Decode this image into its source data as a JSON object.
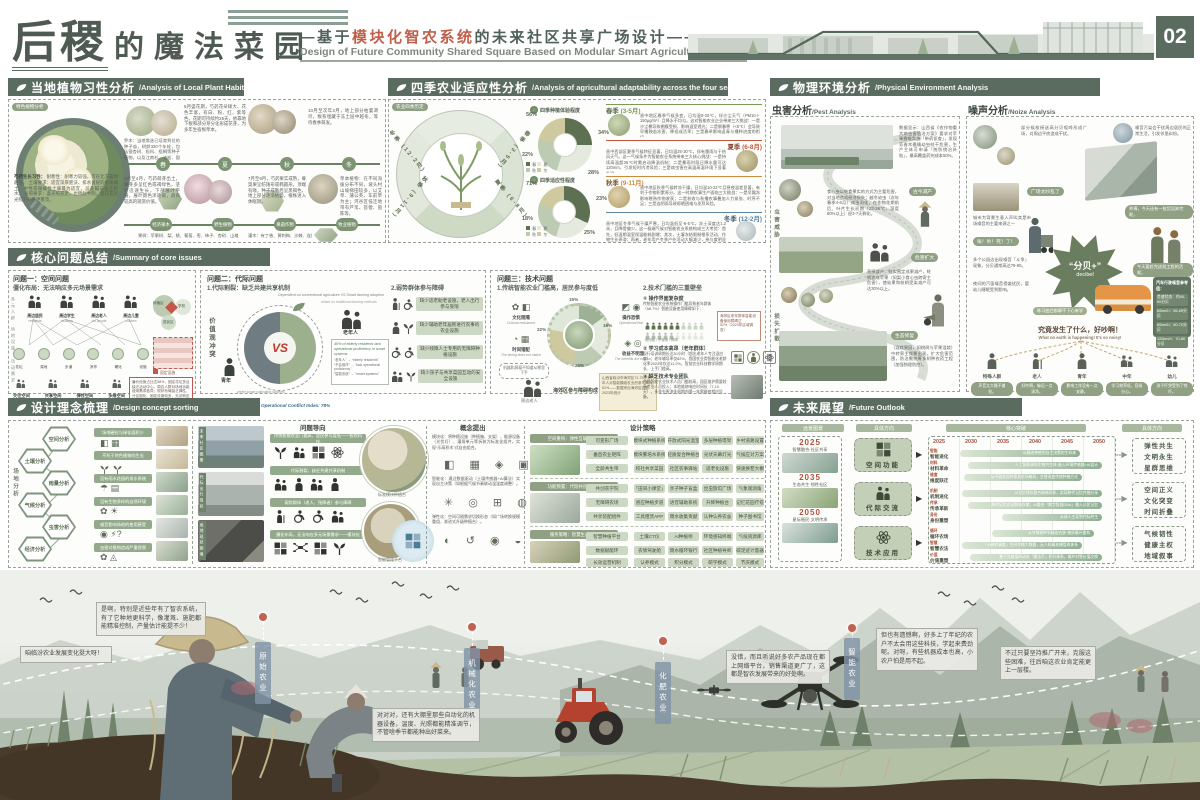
{
  "header": {
    "title_main": "后稷",
    "title_rest": "的魔法菜园",
    "subtitle_prefix": "——基于",
    "subtitle_highlight": "模块化智农系统",
    "subtitle_suffix": "的未来社区共享广场设计——",
    "subtitle_en": "Design of Future Community Shared Square Based on Modular Smart Agriculture System",
    "page_number": "02"
  },
  "plant": {
    "title": "当地植物习性分析",
    "title_en": "Analysis of Local Plant Habits",
    "tag": "特色植物分析",
    "seasons": [
      "春",
      "夏",
      "秋",
      "冬"
    ],
    "types": [
      "经济果木",
      "野生植物",
      "果蔬作物",
      "牧业植物"
    ],
    "note_may": "5月盛花期，芍药花朵硕大、花色丰富，有白、粉、红、紫等色，花期可持续约25天，依靠地下根和部分芽分化形成花芽，为多年生宿根草本。",
    "note_winter": "10月至次年2月，地上部分枯萎凋尽，根系埋藏于冻土层中越冬，等待春季萌发。",
    "note_spring": "3月至4月，芍药萌芽出土，嫩芽多呈红色或褐绿色，茎叶迅速生长，下部展叶平展，展叶期色泽艳丽，具有较高的观赏价值。",
    "note_autumn": "7月至9月，芍药果实成熟，蓇葖果呈纺锤形或椭圆形，顶端有喙，种子成熟后呈黑褐色，地上部分逐渐枯萎，植株进入休眠期。",
    "habit_title": "芍药生长习性：",
    "habit_1": "耐寒性：耐寒力较强，可在北方露地越冬。",
    "habit_2": "土壤要求：适宜深厚肥沃、排水良好的砂质壤土，中性或微碱性土壤最为适宜，忌盐碱与低洼积水。",
    "habit_3": "光照要求：喜光照充足，也稍耐半阴，但在充足光照下开花更繁茂。",
    "note_tree": "乔木：当地常选已培育到位的种子苗，树龄330个年轮，包括银杏树、松科、梧桐等种子植物，以及江南杉、油松、国槐、皂荚子等乔木。",
    "note_fruit": "果树：苹果树、梨、桃、葡萄、枣、柿子、杏树、山楂、猕猴桃；其中，苹果因其丰产稳产、果实好大，包括早熟、晚熟、酿造类。",
    "note_herb": "草本植物：在不同海拔分布不同，坡头村山坡梯田较多，以艾草、蒲公英、车前草为主；河谷区低洼地带有芦苇、苜蓿、茵陈等。",
    "note_shrub": "灌木：有丁香、黄刺梅、沙棘、连翘、文冠果、忍冬、榆叶梅、野蔷薇、胡枝子、山荆子等。"
  },
  "seasons": {
    "title": "四季农业适应性分析",
    "title_en": "Analysis of agricultural adaptability across the four seasons",
    "tag": "农业四季历定",
    "wheel": [
      "春季 (3-5月)",
      "夏季 (6-8月)",
      "秋季 (9-11月)",
      "冬季 (12-2月)"
    ],
    "donut1_title": "四季种植体验程度",
    "donut2_title": "四季适应性程度",
    "legend": [
      "春",
      "夏",
      "秋",
      "冬"
    ],
    "donut1": [
      "56%",
      "34%",
      "28%",
      "22%"
    ],
    "donut2": [
      "71%",
      "23%",
      "25%",
      "18%"
    ],
    "blocks": [
      {
        "name": "春季",
        "months": "(3-5月)",
        "text": "晋中地区春季气候多变，日均温8-20℃，伴沙尘天气（PM10＋150μg/m³）且降水不均匀。这对智能农业企业带来三大挑战：一是沙尘暴导致棚膜受损、影响温室透光；二是倒春寒（<5℃）会导致早播秧苗冻害、降低成活率；三是春旱影响返青与播种进度的衔接。"
      },
      {
        "name": "夏季",
        "months": "(6-8月)",
        "text": "晋中西部区夏季气候特征显著，日均温25-30℃，伴有雷雨与干热风天气。这一气候条件为智能农业系统带来三大核心挑战：一是持续高温超35℃时需启动降温机制；二是暴雨时段日降水量可达120mm，引发短时内涝风险；三是病虫害在高温高湿环境下显著升温。"
      },
      {
        "name": "秋季",
        "months": "(9-11月)",
        "text": "晋中地区秋季气候转凉干燥，日均温10-22℃且昼夜温差显著，有利于作物积累养分。这一时期农事生产面临三大挑战：一是早霜冻影响晚熟作物收获；二是秋收与秋播农事叠加人力紧张、时序不足；三是连阴雨导致晾晒困难与发芽风险。"
      },
      {
        "name": "冬季",
        "months": "(12-2月)",
        "text": "晋中地区冬季气候干燥严寒，日均温低至-8-5℃，冻土深度达1.2米，且降雪偏少。这一极端气候对智能农业系统构成三大考验：首先，低温期温室保温能耗剧增；其次，土壤冻结限制根系活动、作物生长停滞；再者，老年用户冬季户外活动大幅减少，参与度明显下降。"
      }
    ]
  },
  "physical": {
    "title": "物理环境分析",
    "title_en": "Physical Environment Analysis",
    "pest": {
      "title": "虫害分析",
      "title_en": "Pest Analysis",
      "side1": "虫害威胁",
      "side2": "损失扩散",
      "t1": "数据显示：山西省《农作物重大病虫害防治方案》要求对苹果蠹蛾实施「带药侦查」，发现芳香木蠹蛾幼虫蛀干危害，生产主体可申请「统防统治补贴」，最高覆盖药剂成本50%。",
      "t2": "食心虫以蛀食果实的方式为主要危害，对当地造成经济损失；越冬幼虫（次年春季4-6月）成虫羽化，在作物花期前后、叶片生长初期（23-28℃，湿度80%以上）经3-7天孵化。",
      "t3": "直接减产：蛀实围定成果减产，蛀梢造成苹果（如梨小食心虫跨寄主危害），使幼果和枝梢受染减产可达30%以上。",
      "t4": "（混栽果园，如桃树与苹果混栽）中转寄主频繁出现，扩大危害范围，防治需统筹多树种农药工程（加强物理防控）。",
      "pill1": "古今减产",
      "pill2": "危害扩大",
      "pill3": "生态修复"
    },
    "noise": {
      "title": "噪声分析",
      "title_en": "Noize Analysis",
      "star": "“分贝+”",
      "star_en": "decibel",
      "t1": "部分候校接送高分贝喧哗形成广场，对周边平房造成干扰。",
      "t2": "噪音污染会干扰周边居民的正常生活，引发邻里纠纷。",
      "t3": "城市为背景生意人声叫卖是市场噪音的主要来源之一",
      "t4": "多个公园边出现噪音「斗争」现象，分贝通常高达79-90。",
      "t5": "夜间的汽笛噪音侵袭扰民，婴幼儿睡眠受到影响。",
      "b1": "广场太吵乱了",
      "b2": "师傅，今天还有一批货没卸完呢。",
      "b3": "唉！吵！死！了！",
      "b4": "今天要赶完这批工程的活呢。",
      "b5": "练习曲目都静不下心来学",
      "car_title": "汽车行驶噪音参考值：",
      "car_lines": [
        "怠速状态：约40-50分贝",
        "60km/h：55-65分贝",
        "80km/h：60-70分贝",
        "120km/h：70-80分贝"
      ],
      "center": "究竟发生了什么，好吵啊！",
      "center_en": "What on earth is happening! It's so noisy!",
      "groups": [
        {
          "name": "特殊人群",
          "note": "声音太大睡不着觉。"
        },
        {
          "name": "老人",
          "note": "好吵啊，躲远一点清净。"
        },
        {
          "name": "青年",
          "note": "影响工作没有一点安静。"
        },
        {
          "name": "中年",
          "note": "学习效率低，容易分心。"
        },
        {
          "name": "幼儿",
          "note": "孩子吓哭受到了惊吓。"
        }
      ]
    }
  },
  "issues": {
    "title": "核心问题总结",
    "title_en": "Summary of core issues",
    "p1": {
      "title": "问题一：空间问题",
      "sub": "僵化布局：无法响应多元场景需求",
      "crowd": [
        "周边居民",
        "周边学生",
        "周边老人",
        "周边儿童"
      ],
      "crowd_en": [
        "residents",
        "students",
        "old people",
        "children"
      ],
      "sides": [
        "多元人群",
        "场地设施",
        "活动需求"
      ],
      "nodes": [
        "花坛",
        "菜地",
        "步道",
        "凉亭",
        "硬化",
        "设施"
      ],
      "zones": [
        "种植区",
        "学校",
        "居民区"
      ],
      "legend": "固定设施",
      "red_note": "廉价设施占比达58%，固定花坛多且缺乏活动中心，周边人群对场地功能使用需求各异；现状布局缺乏弹性、分区固化、固定设施较多，无法响应人群对功能切换与多样活动的需求。",
      "spaces": [
        "交往空间",
        "共享空间",
        "弹性空间",
        "多维空间"
      ]
    },
    "p2": {
      "title": "问题二：代际问题",
      "sub1": "1.代际割裂：缺乏共建共享机制",
      "sub2": "2.弱势群体参与障碍",
      "vs_top": "Dependent on conventional agriculture VS Smart farming adoption",
      "vs_sub": "reliant on traditional farming methods",
      "left_label": "价值观冲突",
      "youth": "青年",
      "elder": "老年人",
      "vs": "VS",
      "youth_note": "prefer smart cultivation systems",
      "stat": "40% of elderly residents lack operational proficiency in smart systems",
      "gloss1": "“老年人” → “elderly residents”",
      "gloss2": "“不会操作” → “lack operational proficiency”",
      "gloss3": "“智能系统” → “smart systems”",
      "conflict": "Operational Conflict Index: 78%",
      "barriers": [
        "缺少适老助老设施，老人出行参与受限",
        "缺少辅助老年居民进行农事的农业设施",
        "缺少残障人士专用的无障碍种植设施",
        "缺少孩子与共享菜园互动的安全设施"
      ]
    },
    "p3": {
      "title": "问题三：技术问题",
      "sub1": "1.传统智能农业门槛高，居民参与度低",
      "ring": [
        {
          "label": "文化阻隔",
          "en": "Cultural resistance",
          "v": "15%"
        },
        {
          "label": "时间错配",
          "en": "The timing does not match",
          "v": "22%"
        },
        {
          "label": "操作恐惧",
          "en": "Operational fear",
          "v": "16%"
        },
        {
          "label": "收益不明显",
          "en": "The benefits are unclear",
          "v": "25%"
        }
      ],
      "bubble": "机器和屏幕不知道从哪里下手",
      "person": "周边老人",
      "center_note": "海郊区参与障碍构成",
      "foot": "山西省临汾市海郊区71-75岁老年人对智能模组农业的参与率为51%——数据来自海郊区农委2023年统计",
      "sub2": "2.技术门槛的三重壁垒",
      "w1_t": "① 操作界面复杂度",
      "w1_d": "传统智能农业系统操作门槛导致老年群体（58.7%）智能设备使用障碍如下：",
      "w1_side": "海郊区老年群体智能设备使用障碍达52%（2023年区域调查）",
      "w1_leg": "使用者 / 不使用 / 障碍",
      "w2_t": "② 学习成本高昂（老年群体）",
      "w2_d": "现行培训周期长达30小时（超出老年人专注适应度）；老年辅导率仅82%，我国农业类智能化老龄化率2023年仅达11.2%，智慧农业科技教学周期长、上手门槛高。",
      "w3_t": "③ 缺乏技术专业团队",
      "w3_d": "传统智能农业技术人员门槛较高，园区维护需要较多专业人员投入；本地维修响应时间长（7-10天），多季虫害流失周期内隔一年需维修相应设备。"
    }
  },
  "design": {
    "title": "设计理念梳理",
    "title_en": "Design concept sorting",
    "side": "场地分析",
    "hex": [
      "空间分析",
      "土壤分析",
      "雨量分析",
      "气候分析",
      "虫害分析",
      "经济分析"
    ],
    "issues": [
      "场地硬化与绿化面积少",
      "不利于特色植物的生长",
      "没有雨水花园的排水系统",
      "没有生物多样的自然环境",
      "噪音影响场地的使用感受",
      "虫害对植物造成严重侵害"
    ],
    "photo_tags": [
      "未来社区图景",
      "代际出行现状",
      "场地现状困境"
    ],
    "problem_title": "问题导向",
    "problems": [
      "传统智能农业门槛高，居民参与度低——智农科技",
      "代际割裂，缺乏共建共享机制",
      "弱势群体（老人、残障者）参与障碍",
      "僵化布局，无法响应多元场景需求——模块化"
    ],
    "circle1": "标准模块种植台",
    "circle2": "智能管理平台",
    "concept_title": "概念提出",
    "concepts": [
      "模块化：将种植设施（种植箱、支架）、能源设备（光伏灯）、灌溉单元等拆装为标准化组件，实现“乐高积木”式自由组合。",
      "智能化：通过数据驱动（土壤传感器+AI算法）实现自主决策（如根据气候节奏联动温湿度调整）。",
      "弹性化：空间可随需求切换形态（如广场转换规模重组、渐进式升级种植台）。"
    ],
    "strategy_title": "设计策略",
    "groups": [
      {
        "name": "空间重构：弹性互联新模式",
        "rows": [
          {
            "lead": "可变形广场",
            "pills": [
              "模块式种植系统",
              "开放式阳光温室",
              "多层种植塔架",
              "乡村道路设置"
            ]
          },
          {
            "lead": "垂直农业矩阵",
            "pills": [
              "模块雾培水系统",
              "轻质复合种植台",
              "光伏天幕灯光",
              "气候应对方案"
            ]
          },
          {
            "lead": "全龄共生带",
            "pills": [
              "校社共享菜园",
              "社区农事驿站",
              "适老化设施",
              "快速换茬大棚"
            ]
          }
        ]
      },
      {
        "name": "功能预置：代际共创新空间",
        "rows": [
          {
            "lead": "共创农学院",
            "pills": [
              "「田间小课堂」",
              "亲子种子盲盒",
              "昆虫旅馆广场",
              "气象观测角"
            ]
          },
          {
            "lead": "无障碍农场",
            "pills": [
              "感应种植步道",
              "语音辅助系统",
              "升降种植台",
              "记忆花园疗愈"
            ]
          },
          {
            "lead": "共享装配组件",
            "pills": [
              "工具租赁APP",
              "雨水收集贡献",
              "认种认养农舍",
              "种子图书馆"
            ]
          }
        ]
      },
      {
        "name": "服务策略：智慧生态系统",
        "rows": [
          {
            "lead": "智慧种植平台",
            "pills": [
              "土壤CT仪",
              "AI种植师",
              "环境感知终端",
              "气候资源库"
            ]
          },
          {
            "lead": "数据赋能环",
            "pills": [
              "农情驾驶舱",
              "雨水循环银行",
              "社区种植导师",
              "碳足迹计量器"
            ]
          },
          {
            "lead": "长效运营机制",
            "pills": [
              "认养模式",
              "积分模式",
              "研学模式",
              "节庆模式"
            ]
          }
        ]
      }
    ]
  },
  "future": {
    "title": "未来展望",
    "title_en": "Future Outlook",
    "col_heads": [
      "远景图景",
      "具体方向",
      "核心突破",
      "具体方向"
    ],
    "milestones": [
      {
        "year": "2025",
        "label": "智慧融合·社区共享"
      },
      {
        "year": "2035",
        "label": "生态共生·韧性社区"
      },
      {
        "year": "2050",
        "label": "星际殖民·文明传承"
      }
    ],
    "dirs": [
      "空间功能",
      "代际交流",
      "技术应用"
    ],
    "years": [
      "2025",
      "2030",
      "2035",
      "2040",
      "2045",
      "2050"
    ],
    "rows": [
      {
        "tag": "智能",
        "name": "智能进化",
        "bar": "从静态种植到自主决策的生命体"
      },
      {
        "tag": "材料",
        "name": "材料革命",
        "bar": "人工智能调和生物共生体·嵌入环境传感器+AI设计"
      },
      {
        "tag": "维度",
        "name": "维度跃迁",
        "bar": "从平面农园到垂直农场格局，交替改变传统种植方式"
      },
      {
        "tag": "机制",
        "name": "机制进化",
        "bar": "AI记忆保存整合情感同伴，实现跨代记忆共融分享"
      },
      {
        "tag": "传承",
        "name": "传承革新",
        "bar": "跨代记忆花园数据存储，AI整合「数字智慧DNA」植入公民记忆"
      },
      {
        "tag": "身份",
        "name": "身份重塑",
        "bar": "从成人主导到代际共生"
      },
      {
        "tag": "循环",
        "name": "循环农场",
        "bar": "从节律耕种到精准农源·物质循环重构"
      },
      {
        "tag": "智慧",
        "name": "智慧农法",
        "bar": "「AI神农调度」空间作物大数据，无人机精准播管收体系"
      },
      {
        "tag": "价值",
        "name": "价值重塑",
        "bar": "基于贡献值的动态「魔法币」积分体系，城乡对等价值交换"
      }
    ],
    "outcomes": [
      [
        "弹性共生",
        "文明永生",
        "星群思维"
      ],
      [
        "空间正义",
        "文化突变",
        "时间折叠"
      ],
      [
        "气候韧性",
        "健康主权",
        "地域叙事"
      ]
    ]
  },
  "montage": {
    "stages": [
      "原始农业",
      "机械化农业",
      "化肥农业",
      "智能农业"
    ],
    "b1": "咱临汾农业发展变化挺大呀！",
    "b2": "是啊，特别是近些年有了智农系统，有了它种地更科学，像灌溉、施肥都能精准控制，产量估计能提不少！",
    "b3": "对对对，还有大棚里那些自动化的机器设备，温度、光照都能精准调节，不管啥季节都能种出好菜来。",
    "b4": "没错，而且听说好多农产品现在都上网络平台，销售渠道更广了，这都是智农发展带来的好处啊。",
    "b5": "但也有遗憾啊，好多上了年纪的农户不太会用这些科技，学起来费劲呢。对呀，有些机器成本也高，小农户怕是用不起。",
    "b6": "不过只要坚持推广开来，克服这些困难，往后咱这农业肯定能更上一层楼。"
  },
  "chart_data": [
    {
      "type": "pie",
      "title": "四季种植体验程度",
      "categories": [
        "春",
        "夏",
        "秋",
        "冬"
      ],
      "values": [
        56,
        34,
        28,
        22
      ],
      "unit": "%"
    },
    {
      "type": "pie",
      "title": "四季适应性程度",
      "categories": [
        "春",
        "夏",
        "秋",
        "冬"
      ],
      "values": [
        71,
        23,
        25,
        18
      ],
      "unit": "%"
    },
    {
      "type": "pie",
      "title": "传统智能农业参与障碍构成",
      "categories": [
        "文化阻隔",
        "时间错配",
        "操作恐惧",
        "收益不明显"
      ],
      "values": [
        15,
        22,
        16,
        25
      ],
      "unit": "%"
    },
    {
      "type": "table",
      "title": "汽车行驶噪音参考值(分贝)",
      "categories": [
        "怠速",
        "60km/h",
        "80km/h",
        "120km/h"
      ],
      "values": [
        "40-50",
        "55-65",
        "60-70",
        "70-80"
      ]
    },
    {
      "type": "bar",
      "title": "关键统计",
      "categories": [
        "老年人智能系统操作障碍",
        "操作冲突指数",
        "老年群体设备使用障碍",
        "海郊区老年参与率",
        "农业智能化老龄化率"
      ],
      "values": [
        40,
        78,
        52,
        51,
        11.2
      ],
      "unit": "%"
    }
  ]
}
